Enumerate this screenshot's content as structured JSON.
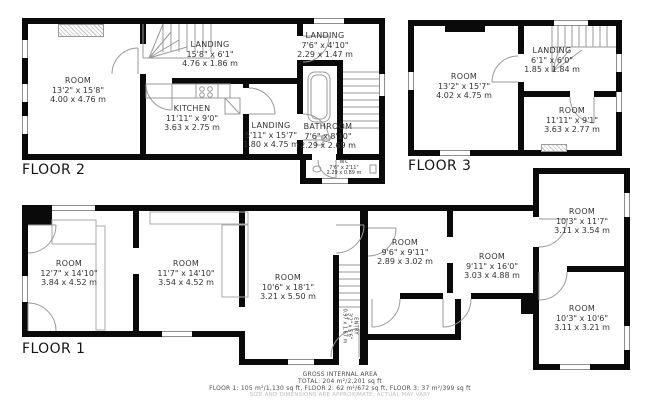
{
  "floors": {
    "floor2": {
      "label": "FLOOR 2",
      "rooms": {
        "room_main": {
          "name": "ROOM",
          "imperial": "13'2\" x 15'8\"",
          "metric": "4.00 x 4.76 m"
        },
        "landing_top": {
          "name": "LANDING",
          "imperial": "15'8\" x 6'1\"",
          "metric": "4.76 x 1.86 m"
        },
        "kitchen": {
          "name": "KITCHEN",
          "imperial": "11'11\" x 9'0\"",
          "metric": "3.63 x 2.75 m"
        },
        "landing_mid": {
          "name": "LANDING",
          "imperial": "5'11\" x 15'7\"",
          "metric": "1.80 x 4.75 m"
        },
        "landing_small": {
          "name": "LANDING",
          "imperial": "7'6\" x 4'10\"",
          "metric": "2.29 x 1.47 m"
        },
        "bathroom": {
          "name": "BATHROOM",
          "imperial": "7'6\" x 8'10\"",
          "metric": "2.29 x 2.69 m"
        },
        "wc": {
          "name": "WC",
          "imperial": "7'6\" x 2'11\"",
          "metric": "2.29 x 0.89 m"
        }
      }
    },
    "floor3": {
      "label": "FLOOR 3",
      "rooms": {
        "room_main": {
          "name": "ROOM",
          "imperial": "13'2\" x 15'7\"",
          "metric": "4.02 x 4.75 m"
        },
        "landing": {
          "name": "LANDING",
          "imperial": "6'1\" x 6'0\"",
          "metric": "1.85 x 1.84 m"
        },
        "room_small": {
          "name": "ROOM",
          "imperial": "11'11\" x 9'1\"",
          "metric": "3.63 x 2.77 m"
        }
      }
    },
    "floor1": {
      "label": "FLOOR 1",
      "rooms": {
        "room_left": {
          "name": "ROOM",
          "imperial": "12'7\" x 14'10\"",
          "metric": "3.84 x 4.52 m"
        },
        "room_mid": {
          "name": "ROOM",
          "imperial": "11'7\" x 14'10\"",
          "metric": "3.54 x 4.52 m"
        },
        "room_center": {
          "name": "ROOM",
          "imperial": "10'6\" x 18'1\"",
          "metric": "3.21 x 5.50 m"
        },
        "room_small": {
          "name": "ROOM",
          "imperial": "9'6\" x 9'11\"",
          "metric": "2.89 x 3.02 m"
        },
        "room_right_mid": {
          "name": "ROOM",
          "imperial": "9'11\" x 16'0\"",
          "metric": "3.03 x 4.88 m"
        },
        "entry": {
          "name": "ENTRY",
          "imperial": "3'2\" x 5'6\"",
          "metric": "0.97 x 1.67 m"
        },
        "room_top_right": {
          "name": "ROOM",
          "imperial": "10'3\" x 11'7\"",
          "metric": "3.11 x 3.54 m"
        },
        "room_bottom_right": {
          "name": "ROOM",
          "imperial": "10'3\" x 10'6\"",
          "metric": "3.11 x 3.21 m"
        }
      }
    }
  },
  "footer": {
    "line1": "GROSS INTERNAL AREA",
    "line2": "TOTAL: 204 m²/2,201 sq ft",
    "line3": "FLOOR 1: 105 m²/1,130 sq ft, FLOOR 2: 62 m²/672 sq ft, FLOOR 3: 37 m²/399 sq ft",
    "line4": "SIZE AND DIMENSIONS ARE APPROXIMATE, ACTUAL MAY VARY"
  },
  "colors": {
    "wall": "#0a0a0a",
    "fixture_line": "#999999",
    "label_text": "#333333",
    "disclaimer_text": "#bdbdbd"
  }
}
